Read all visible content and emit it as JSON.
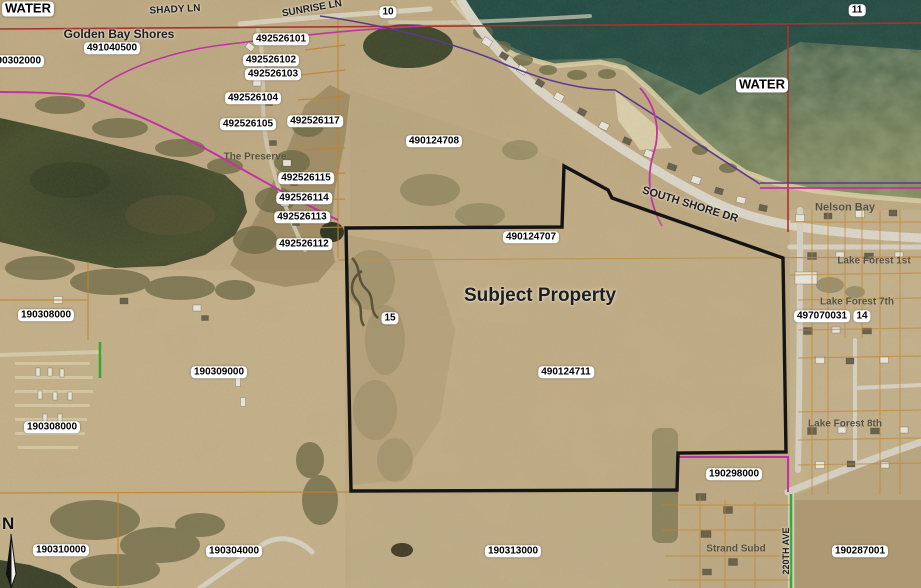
{
  "title": "Aerial parcel map with subject property outline",
  "north_arrow": {
    "label": "N"
  },
  "colors": {
    "subject_boundary": "#141414",
    "section_line_red": "#a8322c",
    "parcel_line_orange": "#c2832d",
    "plat_boundary_magenta": "#c233a0",
    "plat_boundary_purple": "#5a3b8a",
    "road_highlight_green": "#35a832",
    "label_box_bg": "#ffffff"
  },
  "map": {
    "labels": [
      {
        "name": "water-label-left",
        "text": "WATER",
        "x": 28,
        "y": 9,
        "style": "boxed",
        "size": 13
      },
      {
        "name": "road-label-shady-ln",
        "text": "SHADY LN",
        "x": 175,
        "y": 10,
        "style": "plain",
        "size": 10,
        "rotate": -3
      },
      {
        "name": "road-label-sunrise-ln",
        "text": "SUNRISE LN",
        "x": 312,
        "y": 9,
        "style": "plain",
        "size": 10,
        "rotate": -10
      },
      {
        "name": "section-label-10",
        "text": "10",
        "x": 388,
        "y": 12,
        "style": "boxed",
        "size": 10
      },
      {
        "name": "section-label-11",
        "text": "11",
        "x": 857,
        "y": 10,
        "style": "boxed",
        "size": 10
      },
      {
        "name": "subdivision-label-golden-bay-shores",
        "text": "Golden Bay Shores",
        "x": 119,
        "y": 35,
        "style": "plain",
        "size": 12
      },
      {
        "name": "parcel-label-491040500",
        "text": "491040500",
        "x": 112,
        "y": 48,
        "style": "boxed",
        "size": 10
      },
      {
        "name": "parcel-label-190302000",
        "text": "190302000",
        "x": 16,
        "y": 61,
        "style": "boxed",
        "size": 10
      },
      {
        "name": "parcel-label-492526101",
        "text": "492526101",
        "x": 281,
        "y": 39,
        "style": "boxed",
        "size": 10
      },
      {
        "name": "parcel-label-492526102",
        "text": "492526102",
        "x": 271,
        "y": 60,
        "style": "boxed",
        "size": 10
      },
      {
        "name": "parcel-label-492526103",
        "text": "492526103",
        "x": 273,
        "y": 74,
        "style": "boxed",
        "size": 10
      },
      {
        "name": "parcel-label-492526104",
        "text": "492526104",
        "x": 253,
        "y": 98,
        "style": "boxed",
        "size": 10
      },
      {
        "name": "parcel-label-492526105",
        "text": "492526105",
        "x": 248,
        "y": 124,
        "style": "boxed",
        "size": 10
      },
      {
        "name": "parcel-label-492526117",
        "text": "492526117",
        "x": 315,
        "y": 121,
        "style": "boxed",
        "size": 10
      },
      {
        "name": "subdivision-label-the-preserve",
        "text": "The Preserve",
        "x": 255,
        "y": 157,
        "style": "gray",
        "size": 10
      },
      {
        "name": "parcel-label-492526115",
        "text": "492526115",
        "x": 306,
        "y": 178,
        "style": "boxed",
        "size": 10
      },
      {
        "name": "parcel-label-492526114",
        "text": "492526114",
        "x": 304,
        "y": 198,
        "style": "boxed",
        "size": 10
      },
      {
        "name": "parcel-label-492526113",
        "text": "492526113",
        "x": 302,
        "y": 217,
        "style": "boxed",
        "size": 10
      },
      {
        "name": "parcel-label-492526112",
        "text": "492526112",
        "x": 304,
        "y": 244,
        "style": "boxed",
        "size": 10
      },
      {
        "name": "parcel-label-490124708",
        "text": "490124708",
        "x": 434,
        "y": 141,
        "style": "boxed",
        "size": 10
      },
      {
        "name": "water-label-right",
        "text": "WATER",
        "x": 762,
        "y": 85,
        "style": "boxed",
        "size": 13
      },
      {
        "name": "road-label-south-shore-dr",
        "text": "SOUTH SHORE DR",
        "x": 690,
        "y": 205,
        "style": "plain",
        "size": 11,
        "rotate": 17
      },
      {
        "name": "subdivision-label-nelson-bay",
        "text": "Nelson Bay",
        "x": 845,
        "y": 208,
        "style": "gray",
        "size": 11
      },
      {
        "name": "parcel-label-490124707",
        "text": "490124707",
        "x": 531,
        "y": 237,
        "style": "boxed",
        "size": 10
      },
      {
        "name": "subdivision-label-lake-forest-1st",
        "text": "Lake Forest 1st",
        "x": 874,
        "y": 261,
        "style": "gray",
        "size": 10
      },
      {
        "name": "subject-property-label",
        "text": "Subject Property",
        "x": 540,
        "y": 296,
        "style": "plain",
        "size": 19
      },
      {
        "name": "subdivision-label-lake-forest-7th",
        "text": "Lake Forest 7th",
        "x": 857,
        "y": 302,
        "style": "gray",
        "size": 10
      },
      {
        "name": "parcel-label-497070031",
        "text": "497070031",
        "x": 822,
        "y": 316,
        "style": "boxed",
        "size": 10
      },
      {
        "name": "section-label-14",
        "text": "14",
        "x": 862,
        "y": 316,
        "style": "boxed",
        "size": 10
      },
      {
        "name": "section-label-15",
        "text": "15",
        "x": 390,
        "y": 318,
        "style": "boxed",
        "size": 10
      },
      {
        "name": "parcel-label-190308000-north",
        "text": "190308000",
        "x": 46,
        "y": 315,
        "style": "boxed",
        "size": 10
      },
      {
        "name": "parcel-label-190309000",
        "text": "190309000",
        "x": 219,
        "y": 372,
        "style": "boxed",
        "size": 10
      },
      {
        "name": "parcel-label-490124711",
        "text": "490124711",
        "x": 566,
        "y": 372,
        "style": "boxed",
        "size": 10
      },
      {
        "name": "subdivision-label-lake-forest-8th",
        "text": "Lake Forest 8th",
        "x": 845,
        "y": 424,
        "style": "gray",
        "size": 10
      },
      {
        "name": "parcel-label-190308000-south",
        "text": "190308000",
        "x": 52,
        "y": 427,
        "style": "boxed",
        "size": 10
      },
      {
        "name": "parcel-label-190298000",
        "text": "190298000",
        "x": 734,
        "y": 474,
        "style": "boxed",
        "size": 10
      },
      {
        "name": "subdivision-label-strand-subd",
        "text": "Strand Subd",
        "x": 736,
        "y": 549,
        "style": "gray",
        "size": 10
      },
      {
        "name": "road-label-220th-ave",
        "text": "220TH AVE",
        "x": 786,
        "y": 551,
        "style": "plain",
        "size": 9,
        "rotate": -90
      },
      {
        "name": "parcel-label-190310000",
        "text": "190310000",
        "x": 61,
        "y": 550,
        "style": "boxed",
        "size": 10
      },
      {
        "name": "parcel-label-190304000",
        "text": "190304000",
        "x": 234,
        "y": 551,
        "style": "boxed",
        "size": 10
      },
      {
        "name": "parcel-label-190313000",
        "text": "190313000",
        "x": 513,
        "y": 551,
        "style": "boxed",
        "size": 10
      },
      {
        "name": "parcel-label-190287001",
        "text": "190287001",
        "x": 860,
        "y": 551,
        "style": "boxed",
        "size": 10
      }
    ]
  }
}
